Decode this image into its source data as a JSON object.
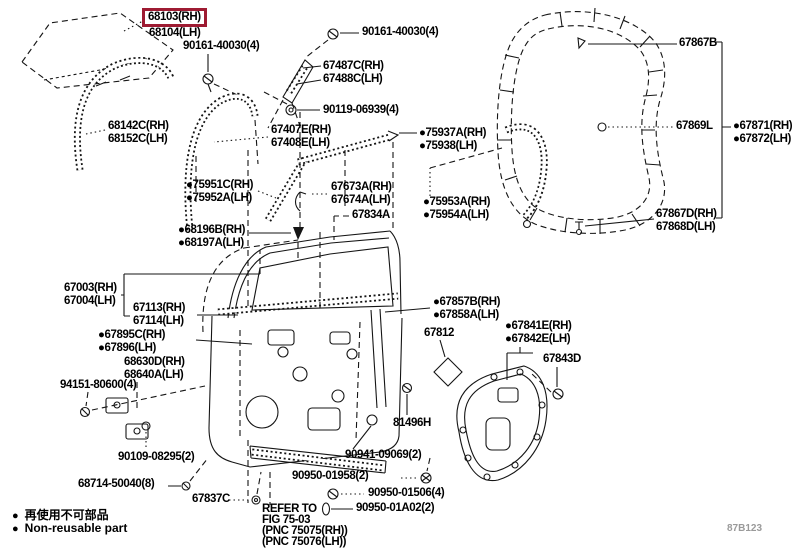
{
  "colors": {
    "background": "#ffffff",
    "line_art": "#151515",
    "highlight_border": "#9e1b32",
    "label_text": "#000000",
    "watermark_text": "#9a9a9a"
  },
  "parts": {
    "glass": {
      "l1": "68103(RH)",
      "l2": "68104(LH)"
    },
    "screw_glass": {
      "l1": "90161-40030(4)"
    },
    "screw_frame": {
      "l1": "90161-40030(4)"
    },
    "run_channel": {
      "l1": "68142C(RH)",
      "l2": "68152C(LH)"
    },
    "frame_corner": {
      "l1": "67487C(RH)",
      "l2": "67488C(LH)"
    },
    "bolt_frame": {
      "l1": "90119-06939(4)"
    },
    "channel_front": {
      "l1": "67407E(RH)",
      "l2": "67408E(LH)"
    },
    "molding_outer": {
      "l1": "●75937A(RH)",
      "l2": "●75938(LH)"
    },
    "molding_front": {
      "l1": "●75951C(RH)",
      "l2": "●75952A(LH)"
    },
    "molding_rear": {
      "l1": "67673A(RH)",
      "l2": "67674A(LH)"
    },
    "channel_rear": {
      "l1": "67834A"
    },
    "molding_inner": {
      "l1": "●75953A(RH)",
      "l2": "●75954A(LH)"
    },
    "pad": {
      "l1": "●68196B(RH)",
      "l2": "●68197A(LH)"
    },
    "weatherstrip_top": {
      "l1": "67867B"
    },
    "weatherstrip_mid": {
      "l1": "67869L"
    },
    "ws_fastener": {
      "l1": "●67871(RH)",
      "l2": "●67872(LH)"
    },
    "weatherstrip_btm": {
      "l1": "67867D(RH)",
      "l2": "67868D(LH)"
    },
    "door_panel": {
      "l1": "67003(RH)",
      "l2": "67004(LH)"
    },
    "door_sub": {
      "l1": "67113(RH)",
      "l2": "67114(LH)"
    },
    "seal": {
      "l1": "●67895C(RH)",
      "l2": "●67896(LH)"
    },
    "check": {
      "l1": "68630D(RH)",
      "l2": "68640A(LH)"
    },
    "hinge_bolt": {
      "l1": "94151-80600(4)"
    },
    "cushion": {
      "l1": "●67857B(RH)",
      "l2": "●67858A(LH)"
    },
    "damper": {
      "l1": "67812"
    },
    "service_cover": {
      "l1": "●67841E(RH)",
      "l2": "●67842E(LH)"
    },
    "cover_clip": {
      "l1": "67843D"
    },
    "bolt_81496": {
      "l1": "81496H"
    },
    "hinge_bolt2": {
      "l1": "90109-08295(2)"
    },
    "screw_68714": {
      "l1": "68714-50040(8)"
    },
    "clip_67837": {
      "l1": "67837C"
    },
    "grommet_90941": {
      "l1": "90941-09069(2)"
    },
    "plug_a": {
      "l1": "90950-01958(2)"
    },
    "plug_b": {
      "l1": "90950-01506(4)"
    },
    "plug_c": {
      "l1": "90950-01A02(2)"
    },
    "refer_note": {
      "l1": "REFER TO",
      "l2": "FIG 75-03",
      "l3": "(PNC 75075(RH))",
      "l4": "(PNC 75076(LH))"
    }
  },
  "legend": {
    "bullet": "●",
    "jp": "再使用不可部品",
    "en": "Non-reusable part"
  },
  "watermark": "87B123"
}
